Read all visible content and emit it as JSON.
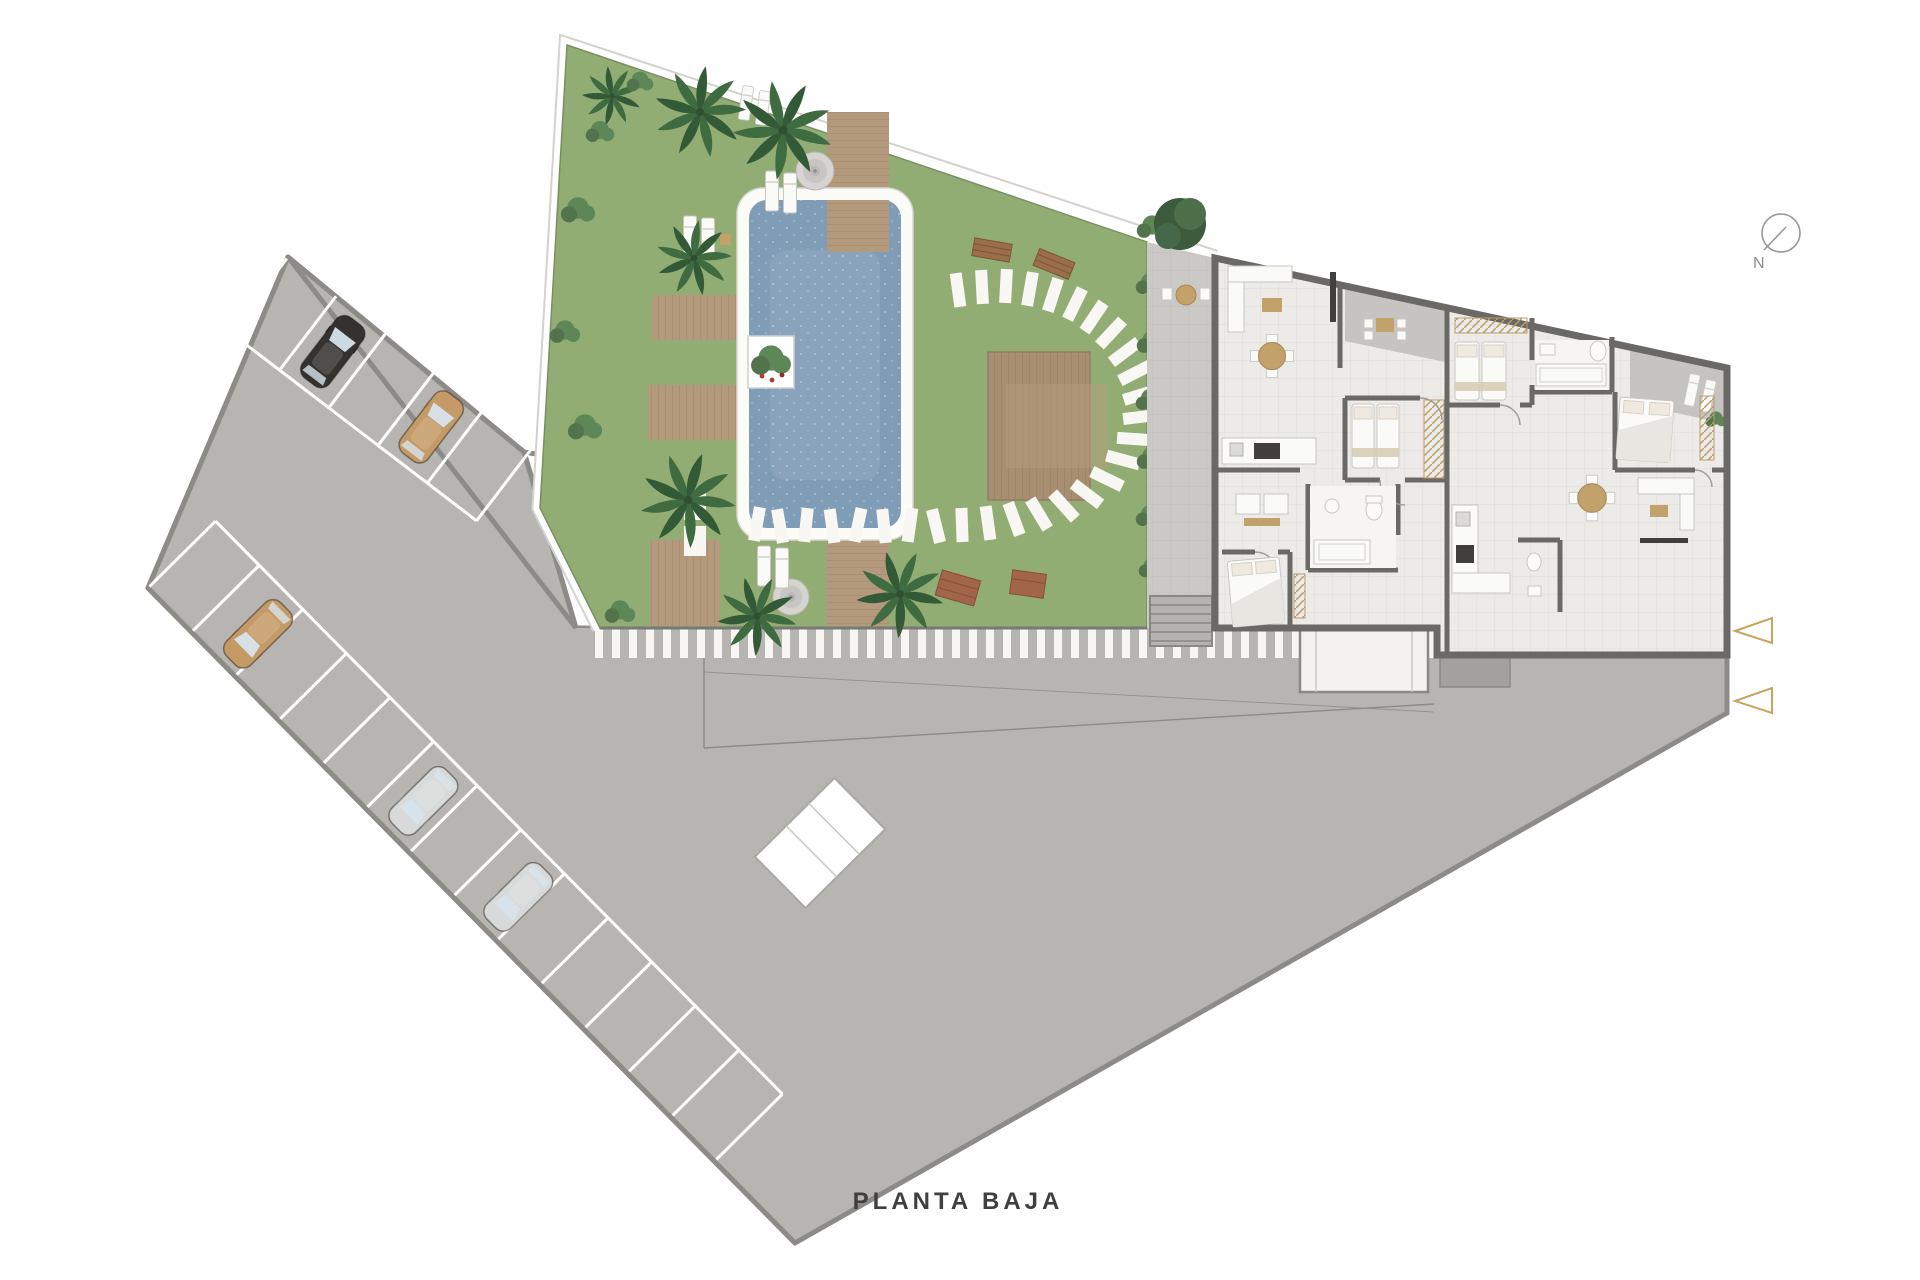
{
  "title": {
    "text": "PLANTA BAJA"
  },
  "compass": {
    "label": "N"
  },
  "colors": {
    "bg": "#ffffff",
    "paving": "#b7b5b2",
    "pavingline": "#8d8b88",
    "stripe": "#f7f6f3",
    "grass": "#92ad74",
    "grassline": "#7a8f60",
    "pool": "#7f9db6",
    "coping": "#fbfbf8",
    "wood": "#b49a7c",
    "wooddark": "#a98f72",
    "bench": "#9b6e4b",
    "planter": "#a2654a",
    "palm": "#3f6b41",
    "palmdark": "#335a36",
    "bush": "#5d8756",
    "hedge": "#52734c",
    "court": "#cbc9c5",
    "floor": "#edebe8",
    "wall": "#6b6965",
    "terrace": "#c6c4c0",
    "white": "#fafaf8",
    "woodfurn": "#c2a26a",
    "dark": "#413f3d",
    "glass": "#d7e4ec",
    "carblack": "#34322f",
    "cartan": "#c49a66",
    "carsilver": "#d8d9d9",
    "arrow": "#c8a55e",
    "muted": "#8f8d8a",
    "title": "#3f3f3f"
  },
  "scene": {
    "type": "architectural-site-plan",
    "floor_label": "PLANTA BAJA",
    "visible_areas": [
      "parking-lot",
      "garden-with-pool",
      "apartment-building",
      "access-road"
    ],
    "parked_cars": {
      "black": 1,
      "tan": 2,
      "silver": 2
    },
    "entry_arrows": 2
  }
}
